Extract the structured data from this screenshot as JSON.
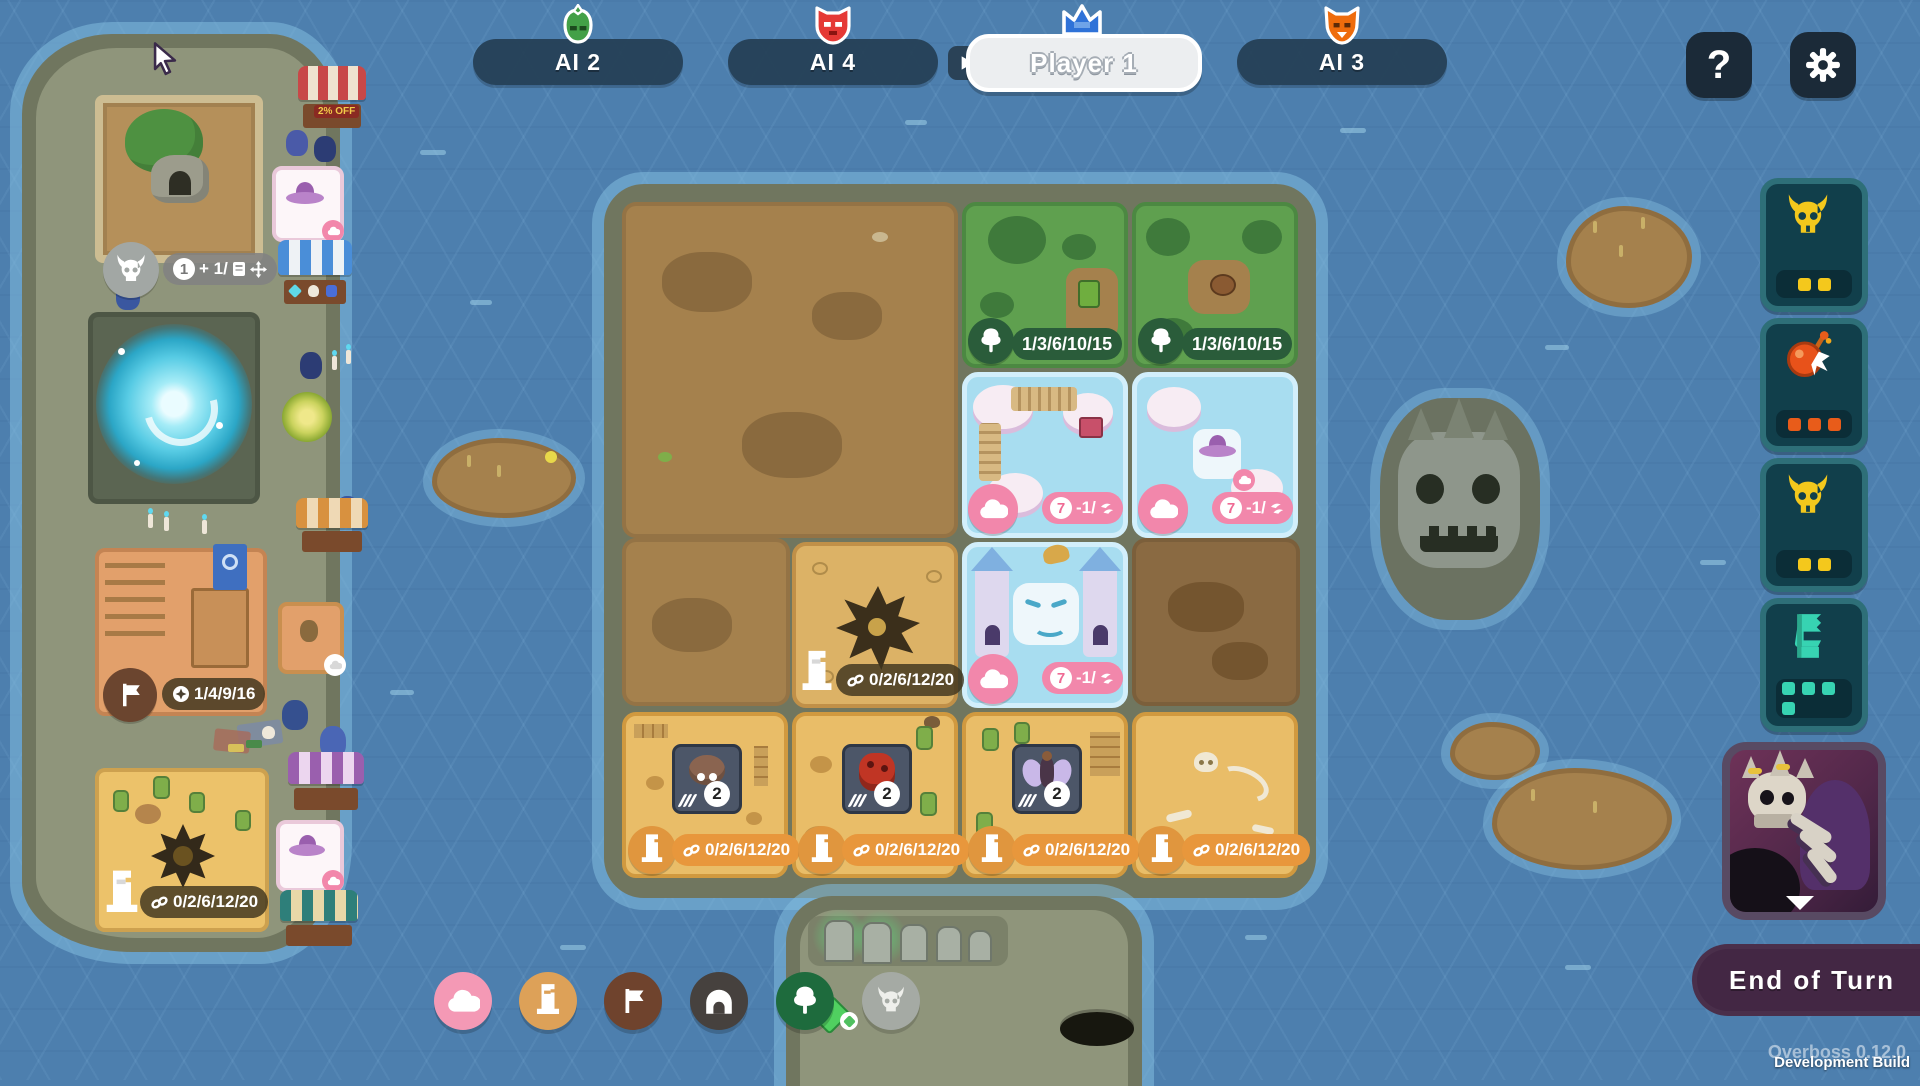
{
  "top_bar": {
    "players": [
      {
        "label": "AI 2",
        "icon": "sprout-demon-icon",
        "accent": "#43a047",
        "active": false
      },
      {
        "label": "AI 4",
        "icon": "red-demon-icon",
        "accent": "#e53935",
        "active": false
      },
      {
        "label": "Player 1",
        "icon": "blue-crown-icon",
        "accent": "#3178d8",
        "active": true
      },
      {
        "label": "AI 3",
        "icon": "orange-demon-icon",
        "accent": "#ef6c0c",
        "active": false
      }
    ],
    "help_label": "?"
  },
  "right_panel": {
    "ability_buttons": [
      {
        "name": "horned-skull-ability",
        "pip_count": 2,
        "pip_color": "#f4c81c"
      },
      {
        "name": "bomb-ability",
        "pip_count": 3,
        "pip_color": "#e85c1a"
      },
      {
        "name": "horned-skull-ability",
        "pip_count": 2,
        "pip_color": "#f4c81c"
      },
      {
        "name": "banner-creature-ability",
        "pip_count": 4,
        "pip_color": "#37d3b2"
      }
    ],
    "boss_portrait": "skeleton-dragon-boss",
    "end_turn_label": "End of Turn"
  },
  "status_bar": {
    "version_overlay": "Overboss  0.12.0",
    "build_label": "Development Build"
  },
  "terrain_filters": [
    {
      "name": "cloud",
      "color": "#f499b5"
    },
    {
      "name": "statue",
      "color": "#dda158"
    },
    {
      "name": "flag",
      "color": "#6f432d"
    },
    {
      "name": "cave",
      "color": "#46413e"
    },
    {
      "name": "tree",
      "color": "#1e6b3d"
    },
    {
      "name": "skull",
      "color": "#a9aeac"
    }
  ],
  "left_island": {
    "shrine_tile": {
      "count": "1",
      "stat_text": "+ 1/"
    },
    "shop_sign": "2% OFF",
    "village_tile": {
      "stat_text": "1/4/9/16"
    },
    "desert_tile": {
      "stat_text": "0/2/6/12/20"
    }
  },
  "map": {
    "forest_tiles": [
      {
        "stat_text": "1/3/6/10/15"
      },
      {
        "stat_text": "1/3/6/10/15"
      }
    ],
    "cloud_tiles": [
      {
        "cost": "7",
        "stat_text": "-1/"
      },
      {
        "cost": "7",
        "stat_text": "-1/"
      },
      {
        "cost": "7",
        "stat_text": "-1/"
      }
    ],
    "crater_tile": {
      "stat_text": "0/2/6/12/20"
    },
    "desert_tiles": [
      {
        "creature": "spider",
        "count": "2",
        "stat_text": "0/2/6/12/20"
      },
      {
        "creature": "beetle",
        "count": "2",
        "stat_text": "0/2/6/12/20"
      },
      {
        "creature": "winged-fairy",
        "count": "2",
        "stat_text": "0/2/6/12/20"
      },
      {
        "creature": "",
        "count": "",
        "stat_text": "0/2/6/12/20"
      }
    ]
  }
}
